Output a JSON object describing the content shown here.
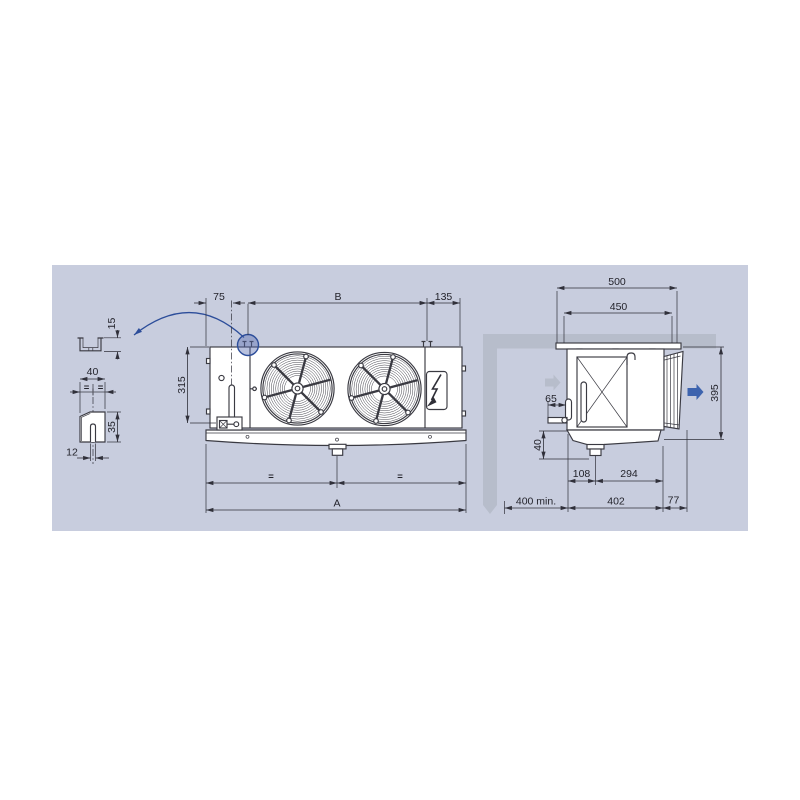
{
  "front_view": {
    "dim_left": "75",
    "dim_span": "B",
    "dim_right": "135",
    "dim_height": "315",
    "dim_equal_left": "=",
    "dim_equal_right": "=",
    "dim_total": "A"
  },
  "side_view": {
    "dim_outer_width": "500",
    "dim_inner_width": "450",
    "dim_height": "395",
    "dim_connection": "65",
    "dim_drain_drop": "40",
    "dim_drain_offset": "108",
    "dim_drain_span": "294",
    "dim_clearance": "400 min.",
    "dim_depth": "402",
    "dim_coil_depth": "77"
  },
  "detail_views": {
    "dim_channel_lip": "15",
    "dim_bracket_width": "40",
    "dim_equal_left": "=",
    "dim_equal_right": "=",
    "dim_bracket_height": "35",
    "dim_slot_width": "12"
  },
  "colors": {
    "panel_bg": "#c8cdde",
    "line": "#3a3a42",
    "wall_gray": "#b7bdcb",
    "accent_blue": "#3d63ae",
    "detail_blue": "#2c4d9a"
  }
}
